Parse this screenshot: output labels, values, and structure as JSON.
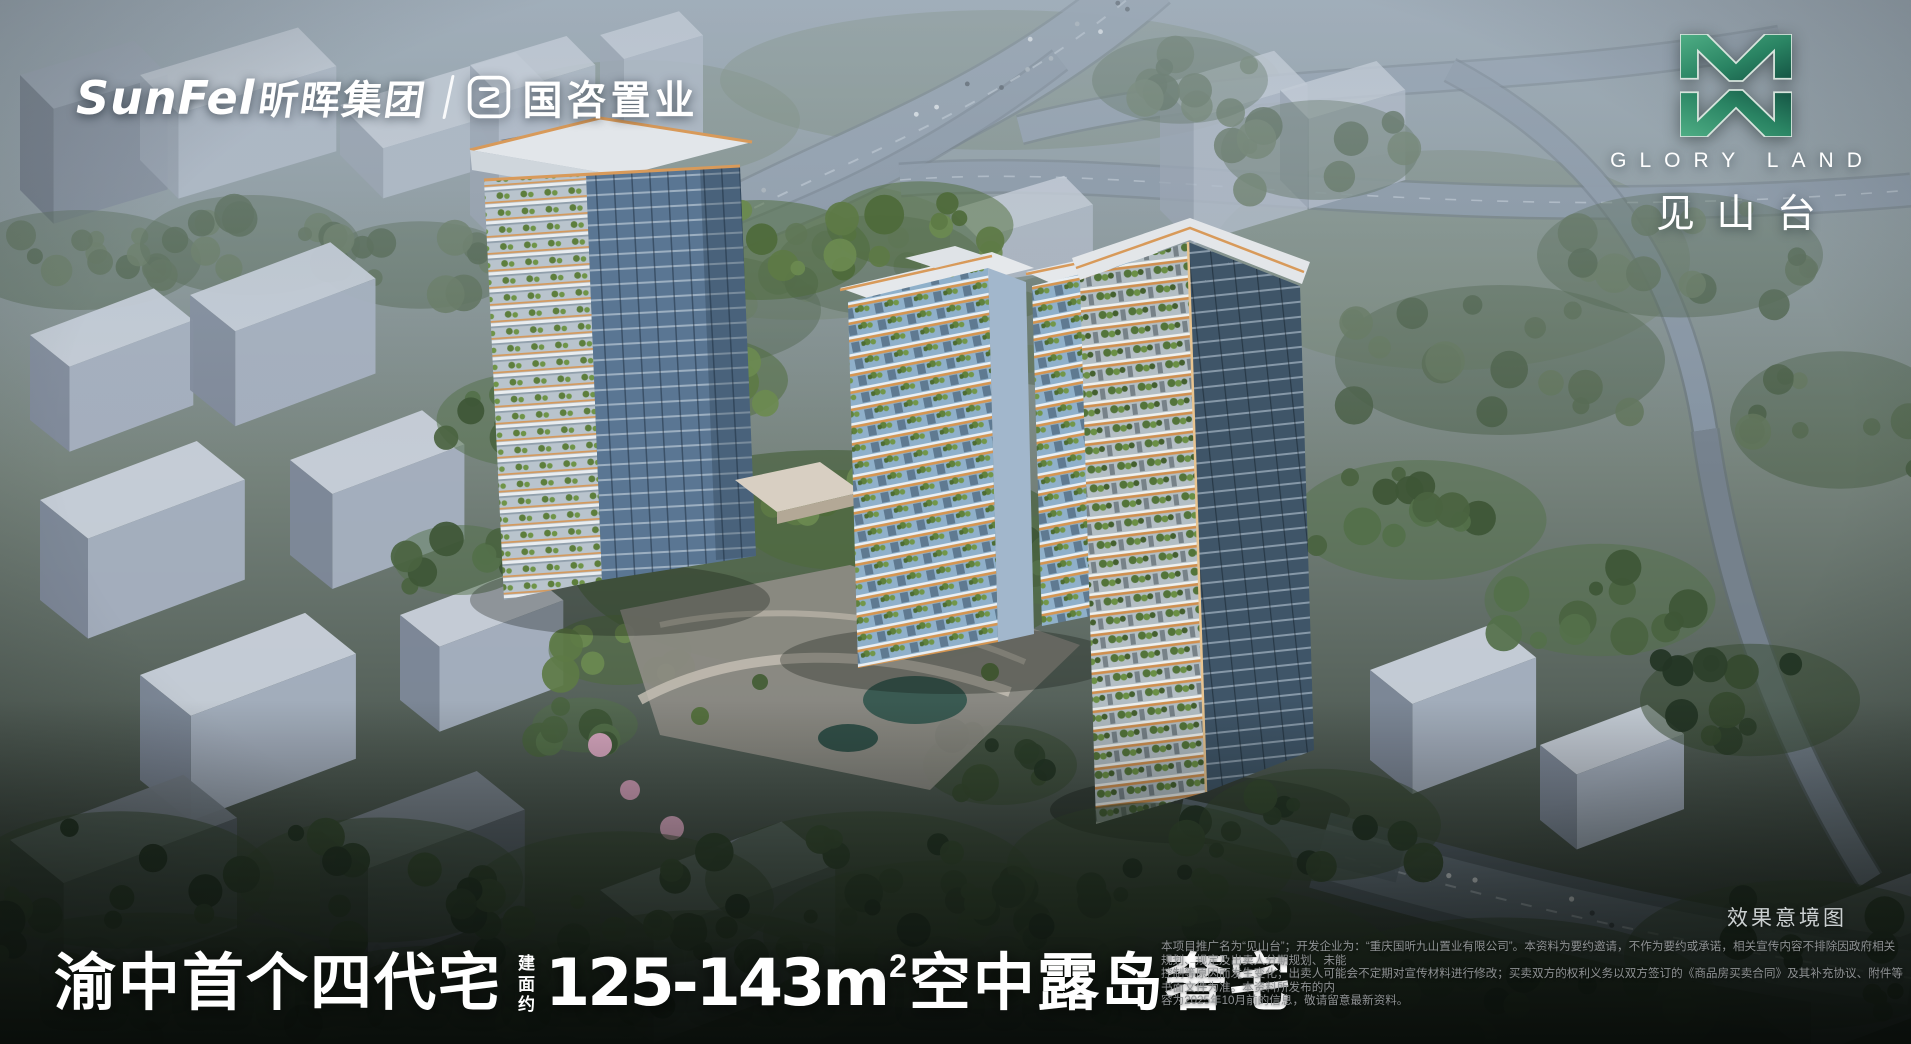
{
  "header": {
    "sunfei_latin": "SunFel",
    "sunfei_cn": "昕晖集团",
    "guozi_cn": "国咨置业",
    "brand_en": "GLORY LAND",
    "brand_cn": "见山台"
  },
  "footer": {
    "headline_part1": "渝中首个四代宅",
    "headline_qualifier": [
      "建",
      "面",
      "约"
    ],
    "headline_area": "125-143m",
    "headline_area_sup": "2",
    "headline_part2": "空中露岛奢宅",
    "caption": "效果意境图",
    "disclaimer_lines": [
      "本项目推广名为“见山台”；开发企业为：“重庆国昕九山置业有限公司”。本资料为要约邀请，不作为要约或承诺，相关宣传内容不排除因政府相关规划、规定及出卖人分期规划、未能",
      "控制等原因而发生变化；出卖人可能会不定期对宣传材料进行修改；买卖双方的权利义务以双方签订的《商品房买卖合同》及其补充协议、附件等书面文件为准。本资料所发布的内",
      "容为2025年10月前的信息，敬请留意最新资料。"
    ]
  },
  "colors": {
    "brand_green_dark": "#145343",
    "brand_green_light": "#4fae85",
    "accent_orange": "#d89a5a",
    "glass_blue": "#5a7693",
    "caption_gray": "#cbd0d1",
    "disclaimer_gray": "#8e9193",
    "text_white": "#ffffff"
  }
}
